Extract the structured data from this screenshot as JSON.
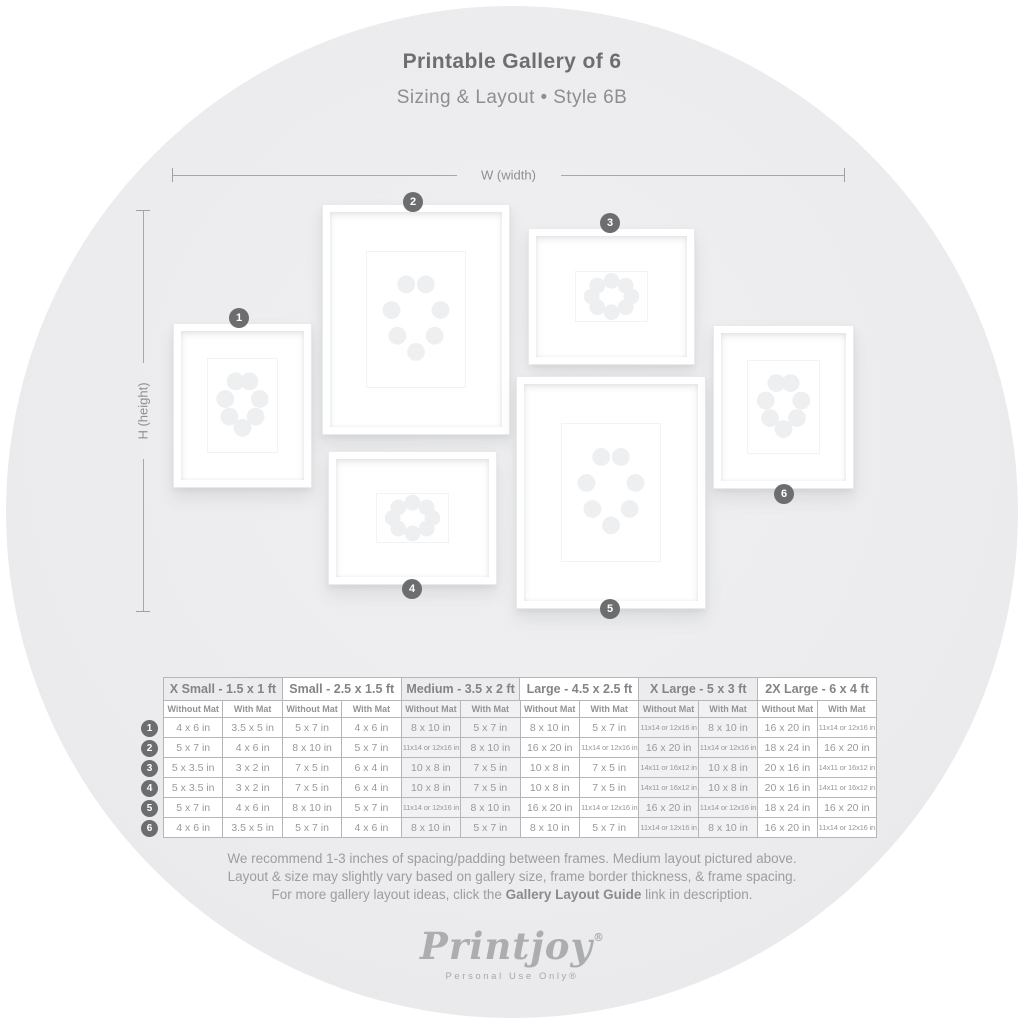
{
  "header": {
    "title": "Printable Gallery of 6",
    "subtitle": "Sizing & Layout • Style 6B"
  },
  "diagram": {
    "width_label": "W (width)",
    "height_label": "H (height)",
    "frames": [
      {
        "number": "1"
      },
      {
        "number": "2"
      },
      {
        "number": "3"
      },
      {
        "number": "4"
      },
      {
        "number": "5"
      },
      {
        "number": "6"
      }
    ]
  },
  "table": {
    "size_columns": [
      {
        "label": "X Small - 1.5 x 1 ft"
      },
      {
        "label": "Small - 2.5 x 1.5 ft"
      },
      {
        "label": "Medium - 3.5 x 2 ft"
      },
      {
        "label": "Large - 4.5 x 2.5 ft"
      },
      {
        "label": "X Large - 5 x 3 ft"
      },
      {
        "label": "2X Large - 6 x 4 ft"
      }
    ],
    "subheaders": [
      "Without Mat",
      "With Mat"
    ],
    "rows": [
      {
        "number": "1",
        "cells": [
          "4 x 6 in",
          "3.5 x 5 in",
          "5 x 7 in",
          "4 x 6 in",
          "8 x 10 in",
          "5 x 7 in",
          "8 x 10 in",
          "5 x 7 in",
          "11x14 or 12x16 in",
          "8 x 10 in",
          "16 x 20 in",
          "11x14 or 12x16 in"
        ]
      },
      {
        "number": "2",
        "cells": [
          "5 x 7 in",
          "4 x 6 in",
          "8 x 10 in",
          "5 x 7 in",
          "11x14 or 12x16 in",
          "8 x 10 in",
          "16 x 20 in",
          "11x14 or 12x16 in",
          "16 x 20 in",
          "11x14 or 12x16 in",
          "18 x 24 in",
          "16 x 20 in"
        ]
      },
      {
        "number": "3",
        "cells": [
          "5 x 3.5 in",
          "3 x 2 in",
          "7 x 5 in",
          "6 x 4 in",
          "10 x 8 in",
          "7 x 5 in",
          "10 x 8 in",
          "7 x 5 in",
          "14x11 or 16x12 in",
          "10 x 8 in",
          "20 x 16 in",
          "14x11 or 16x12 in"
        ]
      },
      {
        "number": "4",
        "cells": [
          "5 x 3.5 in",
          "3 x 2 in",
          "7 x 5 in",
          "6 x 4 in",
          "10 x 8 in",
          "7 x 5 in",
          "10 x 8 in",
          "7 x 5 in",
          "14x11 or 16x12 in",
          "10 x 8 in",
          "20 x 16 in",
          "14x11 or 16x12 in"
        ]
      },
      {
        "number": "5",
        "cells": [
          "5 x 7 in",
          "4 x 6 in",
          "8 x 10 in",
          "5 x 7 in",
          "11x14 or 12x16 in",
          "8 x 10 in",
          "16 x 20 in",
          "11x14 or 12x16 in",
          "16 x 20 in",
          "11x14 or 12x16 in",
          "18 x 24 in",
          "16 x 20 in"
        ]
      },
      {
        "number": "6",
        "cells": [
          "4 x 6 in",
          "3.5 x 5 in",
          "5 x 7 in",
          "4 x 6 in",
          "8 x 10 in",
          "5 x 7 in",
          "8 x 10 in",
          "5 x 7 in",
          "11x14 or 12x16 in",
          "8 x 10 in",
          "16 x 20 in",
          "11x14 or 12x16 in"
        ]
      }
    ]
  },
  "footer": {
    "line1": "We recommend 1-3 inches of spacing/padding between frames. Medium layout pictured above.",
    "line2": "Layout & size may slightly vary based on gallery size, frame border thickness, & frame spacing.",
    "line3_prefix": "For more gallery layout ideas, click the ",
    "line3_bold": "Gallery Layout Guide",
    "line3_suffix": " link in description.",
    "logo": "Printjoy",
    "logo_reg": "®",
    "tagline": "Personal Use Only®"
  },
  "colors": {
    "badge": "#6c6d6f",
    "circle_bg": "#ececee",
    "table_border": "#b4b6b8",
    "title_text": "#6d6e70"
  }
}
